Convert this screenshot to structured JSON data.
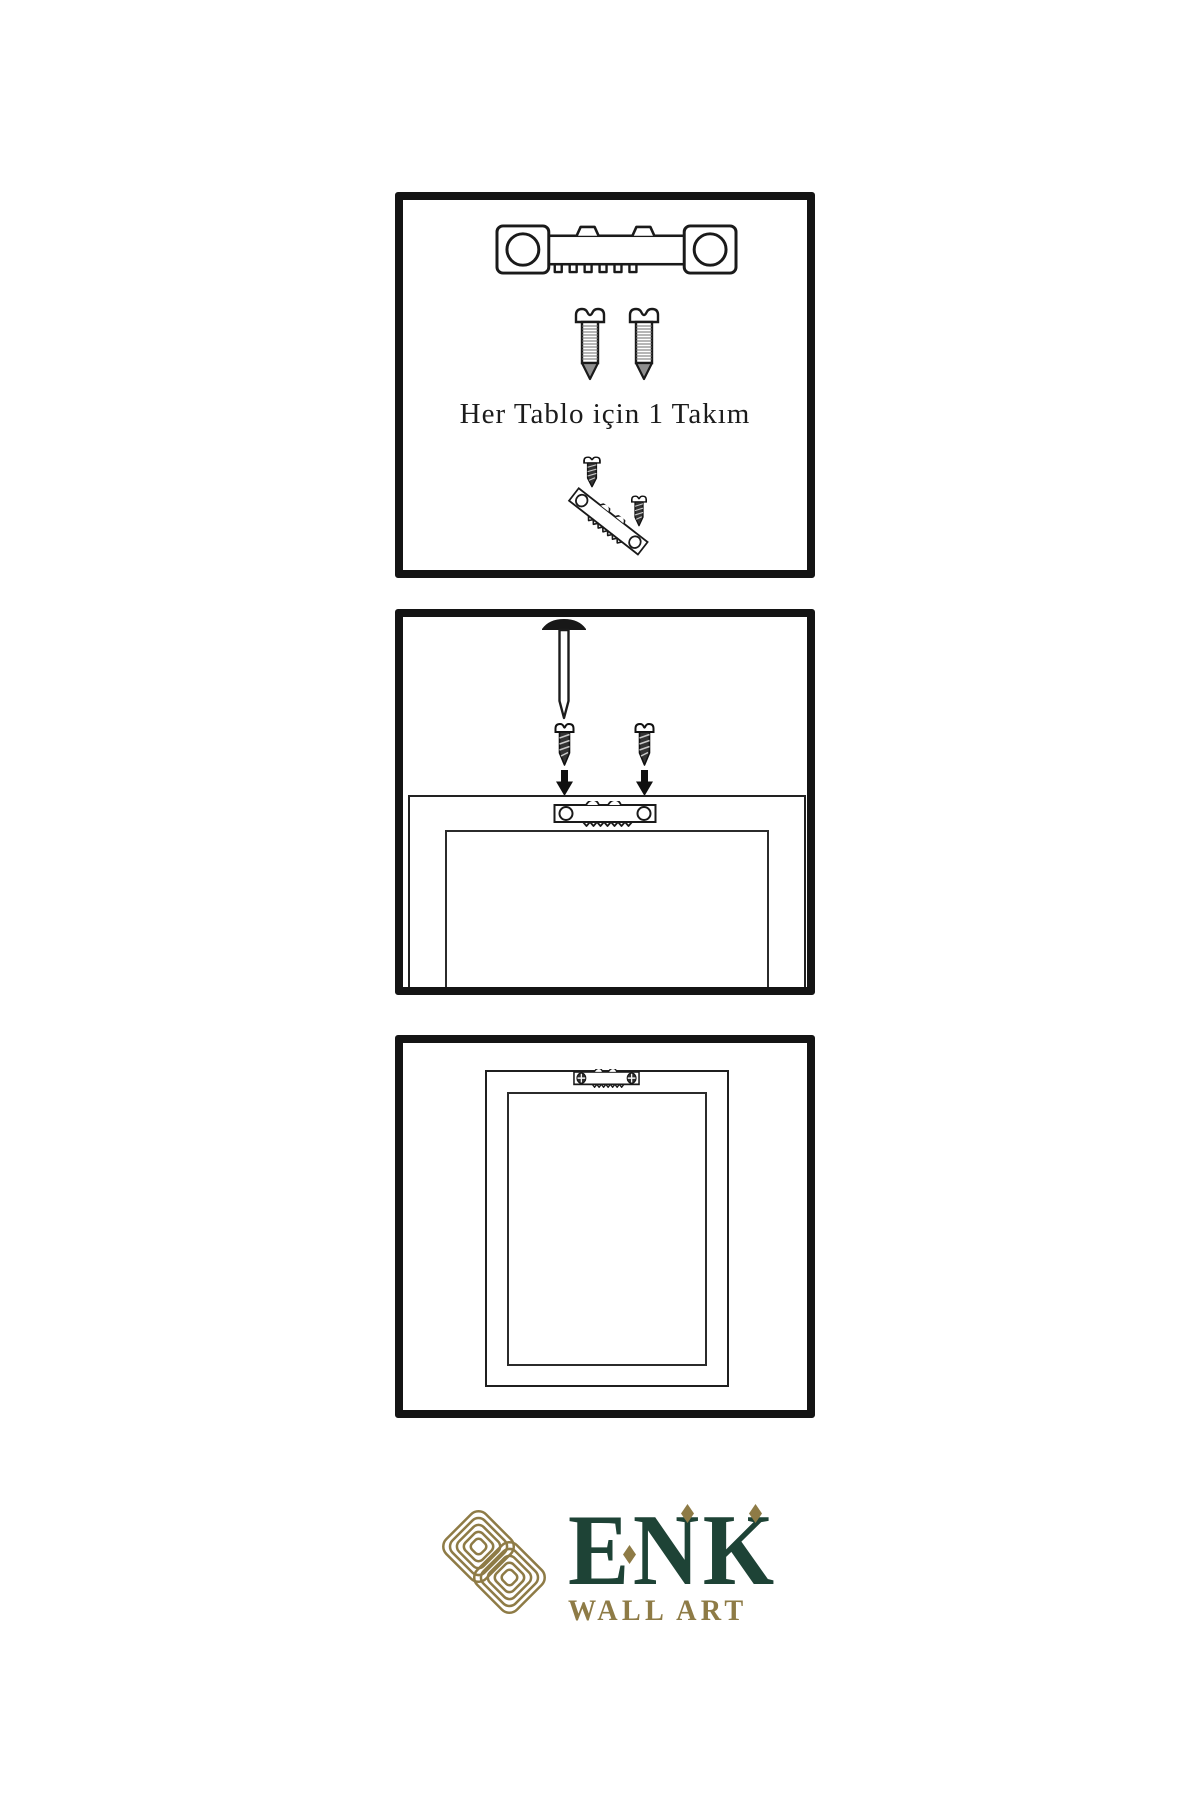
{
  "colors": {
    "ink": "#141414",
    "line": "#222222",
    "logo_gold": "#8e7b46",
    "logo_green": "#1e4336"
  },
  "step1": {
    "caption": "Her Tablo için 1 Takım"
  },
  "logo": {
    "brand": "ENK",
    "subtitle": "WALL ART"
  },
  "icons": {
    "hanger": "sawtooth-hanger-icon",
    "screw": "screw-icon",
    "nail": "nail-icon",
    "arrow": "arrow-down-icon",
    "knot": "knot-logo-icon",
    "diamond": "diamond-icon"
  }
}
